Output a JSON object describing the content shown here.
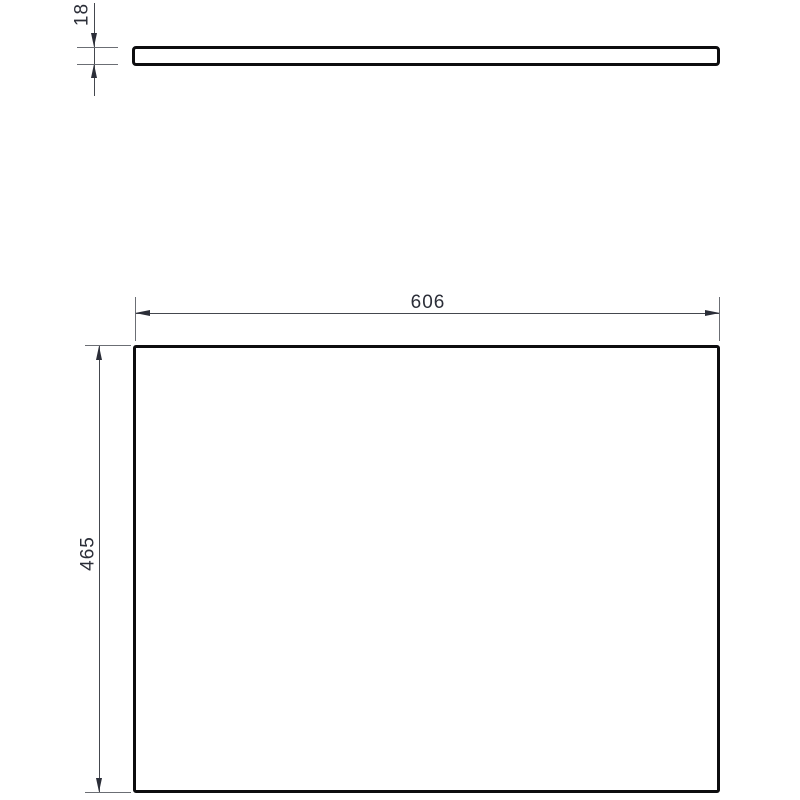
{
  "drawing": {
    "type": "technical-dimension-drawing",
    "views": {
      "side_view": {
        "shape": "thin-horizontal-bar",
        "represents": "panel-edge-profile"
      },
      "front_view": {
        "shape": "rectangle",
        "represents": "panel-face"
      }
    },
    "dimensions": {
      "thickness": "18",
      "width": "606",
      "height": "465"
    },
    "colors": {
      "outline": "#0d0d0f",
      "dimension_line": "#44474e",
      "extension_line": "#6b6e74",
      "arrow": "#2b2e38",
      "label_text": "#2b2e38",
      "background": "#ffffff"
    }
  }
}
